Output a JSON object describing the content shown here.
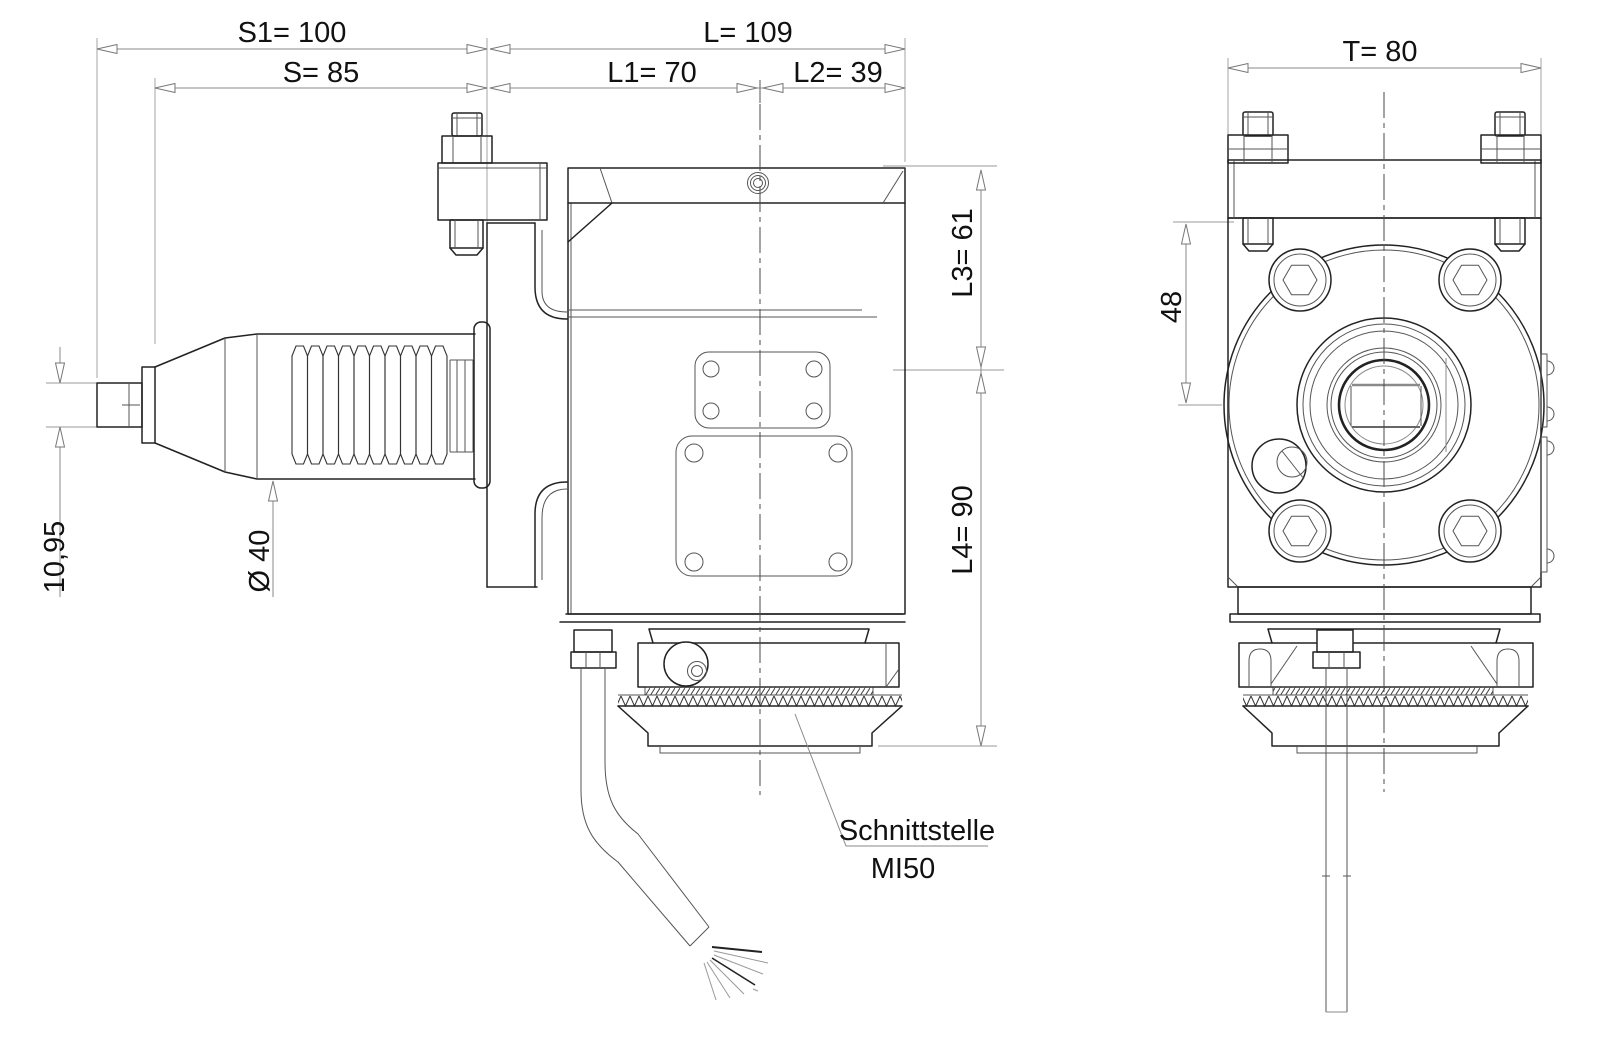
{
  "drawing": {
    "dimensions": {
      "s1": "S1= 100",
      "s": "S= 85",
      "l": "L= 109",
      "l1": "L1= 70",
      "l2": "L2= 39",
      "t": "T= 80",
      "l3": "L3= 61",
      "l4": "L4= 90",
      "width48": "48",
      "pin_height": "10,95",
      "shank_dia": "Ø 40"
    },
    "note": {
      "line1": "Schnittstelle",
      "line2": "MI50"
    },
    "colors": {
      "outline": "#222222",
      "dim": "#8a8a8a",
      "text": "#111111",
      "background": "#ffffff"
    }
  }
}
